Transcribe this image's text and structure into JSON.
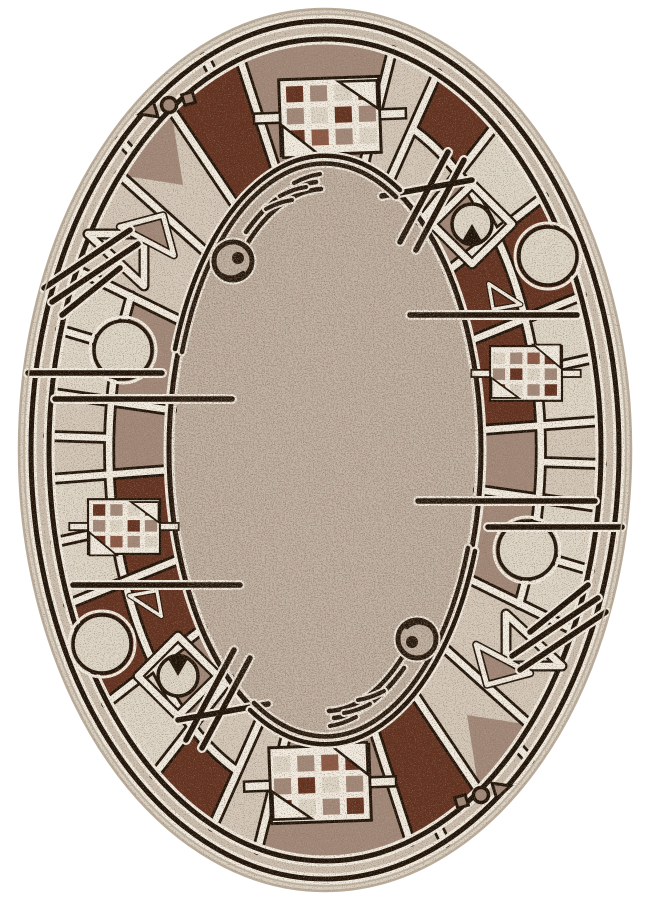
{
  "image": {
    "kind": "product-photo",
    "subject": "oval area rug with geometric abstract border pattern",
    "background": "plain white",
    "width_px": 650,
    "height_px": 900
  },
  "rug": {
    "shape": "oval",
    "symmetry": "180-degree rotational",
    "texture": "heathered mottled pile with dark speckles",
    "zones": [
      "cream outer edge",
      "thin dark outline band",
      "speckled beige band",
      "segmented ornament ring",
      "speckled taupe inner field"
    ]
  },
  "motifs": [
    "window-grid lattice with colored panes and white triangles",
    "large circle medallion on mauve/brown block",
    "circle with dark wedge inside white diamond outline",
    "white triangle outlines (open and mauve-filled)",
    "glyph row: small square, ring, triangle",
    "diagonal double slash lines crossing the bands",
    "straight accent bars crossing ring and field",
    "concentric arc pairs in the field",
    "spiral ring with dot",
    "three short dash arcs"
  ],
  "palette": {
    "white_bg": "#ffffff",
    "cream_edge": "#d8cfc1",
    "band_beige": "#cbbeae",
    "ring_beige": "#d3c7b8",
    "field_taupe": "#c2b4a5",
    "block_cream": "#ddd5c6",
    "mauve": "#a18878",
    "rust": "#8a5844",
    "dark_brown": "#62311f",
    "line_dark": "#201409",
    "line_light": "#f1ebdf",
    "speckle_dark": "#38241a",
    "speckle_light": "#f3ecdf",
    "edge_shadow": "#b9ab99"
  }
}
